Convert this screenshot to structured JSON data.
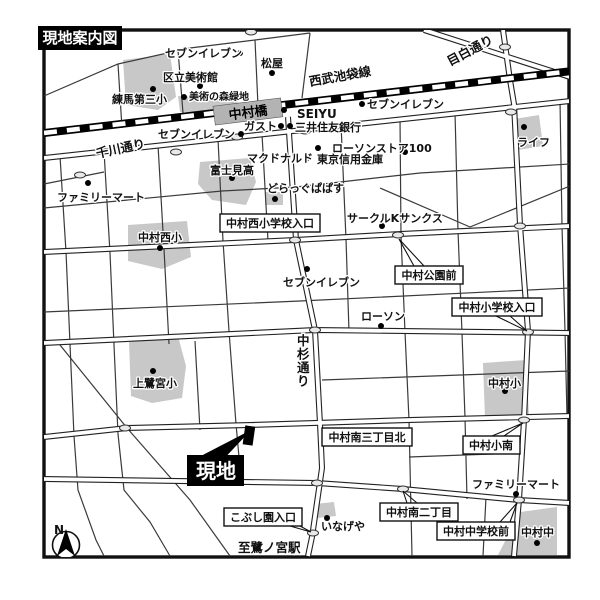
{
  "title": "現地案内図",
  "site": {
    "label": "現地"
  },
  "compass": {
    "north": "N"
  },
  "railway": {
    "line": "西武池袋線",
    "station": "中村橋"
  },
  "roads": {
    "senkawa_dori": "千川通り",
    "mejiro_dori": "目白通り",
    "nakasugi_dori": "中杉通り",
    "to_saginomiya": "至鷺ノ宮駅"
  },
  "pois": [
    {
      "name": "セブンイレブン"
    },
    {
      "name": "区立美術館"
    },
    {
      "name": "練馬第三小"
    },
    {
      "name": "美術の森緑地"
    },
    {
      "name": "松屋"
    },
    {
      "name": "SEIYU"
    },
    {
      "name": "セブンイレブン"
    },
    {
      "name": "ガスト"
    },
    {
      "name": "三井住友銀行"
    },
    {
      "name": "セブンイレブン"
    },
    {
      "name": "ローソンストア100"
    },
    {
      "name": "マクドナルド"
    },
    {
      "name": "東京信用金庫"
    },
    {
      "name": "ファミリーマート"
    },
    {
      "name": "富士見高"
    },
    {
      "name": "どらっぐぱぱす"
    },
    {
      "name": "ライフ"
    },
    {
      "name": "中村西小"
    },
    {
      "name": "サークルKサンクス"
    },
    {
      "name": "セブンイレブン"
    },
    {
      "name": "ローソン"
    },
    {
      "name": "上鷺宮小"
    },
    {
      "name": "中村小"
    },
    {
      "name": "ファミリーマート"
    },
    {
      "name": "いなげや"
    },
    {
      "name": "中村中"
    }
  ],
  "intersections": [
    {
      "name": "中村西小学校入口"
    },
    {
      "name": "中村公園前"
    },
    {
      "name": "中村小学校入口"
    },
    {
      "name": "中村南三丁目北"
    },
    {
      "name": "中村小南"
    },
    {
      "name": "中村南二丁目"
    },
    {
      "name": "中村中学校前"
    },
    {
      "name": "こぶし園入口"
    }
  ],
  "colors": {
    "building": "#c8c8c8",
    "station": "#b3b3b3",
    "road": "#3a3a3a",
    "railway": "#000000",
    "background": "#ffffff"
  }
}
